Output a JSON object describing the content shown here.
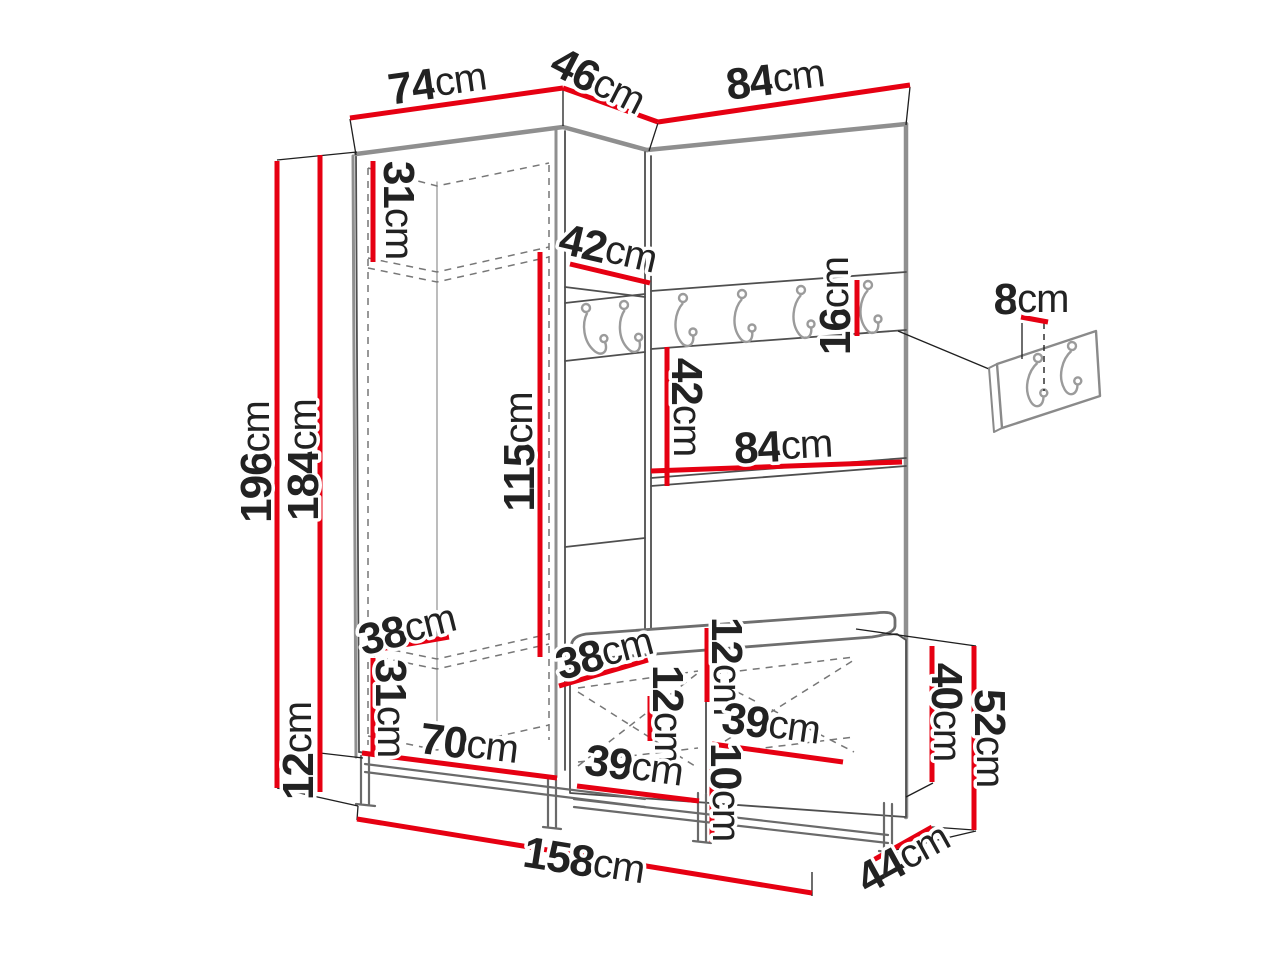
{
  "page": {
    "background": "#ffffff"
  },
  "style": {
    "dimension_line_color": "#e60012",
    "outline_color": "#4f4f4f",
    "thick_edge_color": "#8f8f8f",
    "dashed_line_color": "#777777",
    "label_color": "#222222"
  },
  "diagram": {
    "kind": "furniture dimensioned line drawing",
    "subject": "corner hallway wardrobe with hook rail, wall hook panel and shoe bench",
    "unit": "cm",
    "rail_hook_count": 6,
    "wall_panel_hook_count": 2,
    "dims": {
      "top_74": {
        "v": "74",
        "u": "cm"
      },
      "top_46": {
        "v": "46",
        "u": "cm"
      },
      "top_84": {
        "v": "84",
        "u": "cm"
      },
      "height_196": {
        "v": "196",
        "u": "cm"
      },
      "height_184": {
        "v": "184",
        "u": "cm"
      },
      "plinth_12": {
        "v": "12",
        "u": "cm"
      },
      "shelf_31": {
        "v": "31",
        "u": "cm"
      },
      "hang_115": {
        "v": "115",
        "u": "cm"
      },
      "corner_shelf_42": {
        "v": "42",
        "u": "cm"
      },
      "panel_gap_42": {
        "v": "42",
        "u": "cm"
      },
      "rail_16": {
        "v": "16",
        "u": "cm"
      },
      "panel_width_84": {
        "v": "84",
        "u": "cm"
      },
      "hook_panel_8": {
        "v": "8",
        "u": "cm"
      },
      "ward_depth_38": {
        "v": "38",
        "u": "cm"
      },
      "ward_bottom_31": {
        "v": "31",
        "u": "cm"
      },
      "ward_width_70": {
        "v": "70",
        "u": "cm"
      },
      "bench_depth_38": {
        "v": "38",
        "u": "cm"
      },
      "bench_12_a": {
        "v": "12",
        "u": "cm"
      },
      "bench_12_b": {
        "v": "12",
        "u": "cm"
      },
      "bench_39_a": {
        "v": "39",
        "u": "cm"
      },
      "bench_39_b": {
        "v": "39",
        "u": "cm"
      },
      "bench_10": {
        "v": "10",
        "u": "cm"
      },
      "bench_40": {
        "v": "40",
        "u": "cm"
      },
      "bench_52": {
        "v": "52",
        "u": "cm"
      },
      "depth_44": {
        "v": "44",
        "u": "cm"
      },
      "total_width_158": {
        "v": "158",
        "u": "cm"
      }
    }
  }
}
